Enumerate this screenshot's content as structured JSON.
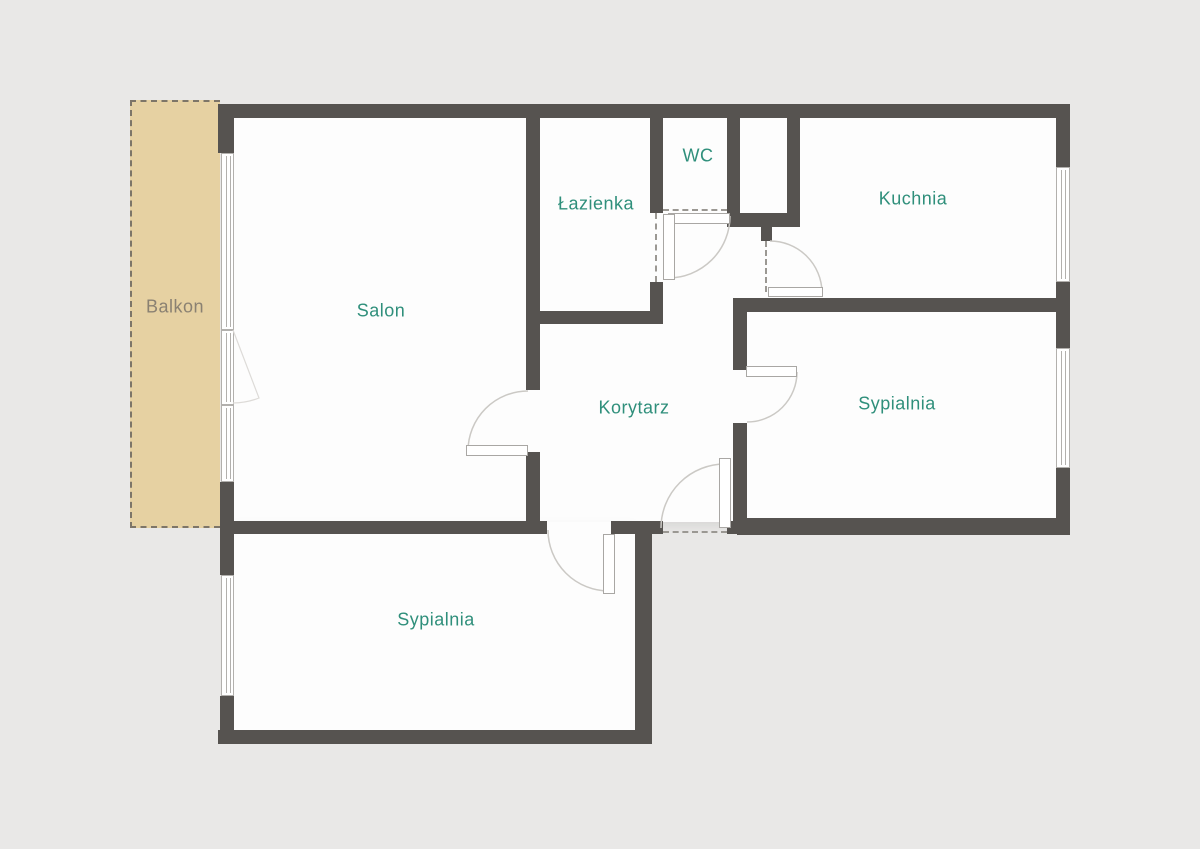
{
  "type": "floor-plan",
  "rooms": [
    {
      "id": "balkon",
      "label": "Balkon"
    },
    {
      "id": "salon",
      "label": "Salon"
    },
    {
      "id": "lazienka",
      "label": "Łazienka"
    },
    {
      "id": "wc",
      "label": "WC"
    },
    {
      "id": "kuchnia",
      "label": "Kuchnia"
    },
    {
      "id": "korytarz",
      "label": "Korytarz"
    },
    {
      "id": "sypialnia_right",
      "label": "Sypialnia"
    },
    {
      "id": "sypialnia_bottom",
      "label": "Sypialnia"
    }
  ],
  "colors": {
    "background": "#e9e8e7",
    "room_fill": "#fdfdfd",
    "wall": "#565350",
    "balcony_fill": "#e6d1a2",
    "balcony_border": "#7d7568",
    "room_label": "#2f8f7b",
    "balcony_label": "#8a8172",
    "window_frame": "#b2b0ad",
    "door_arc": "#cbc9c5"
  }
}
